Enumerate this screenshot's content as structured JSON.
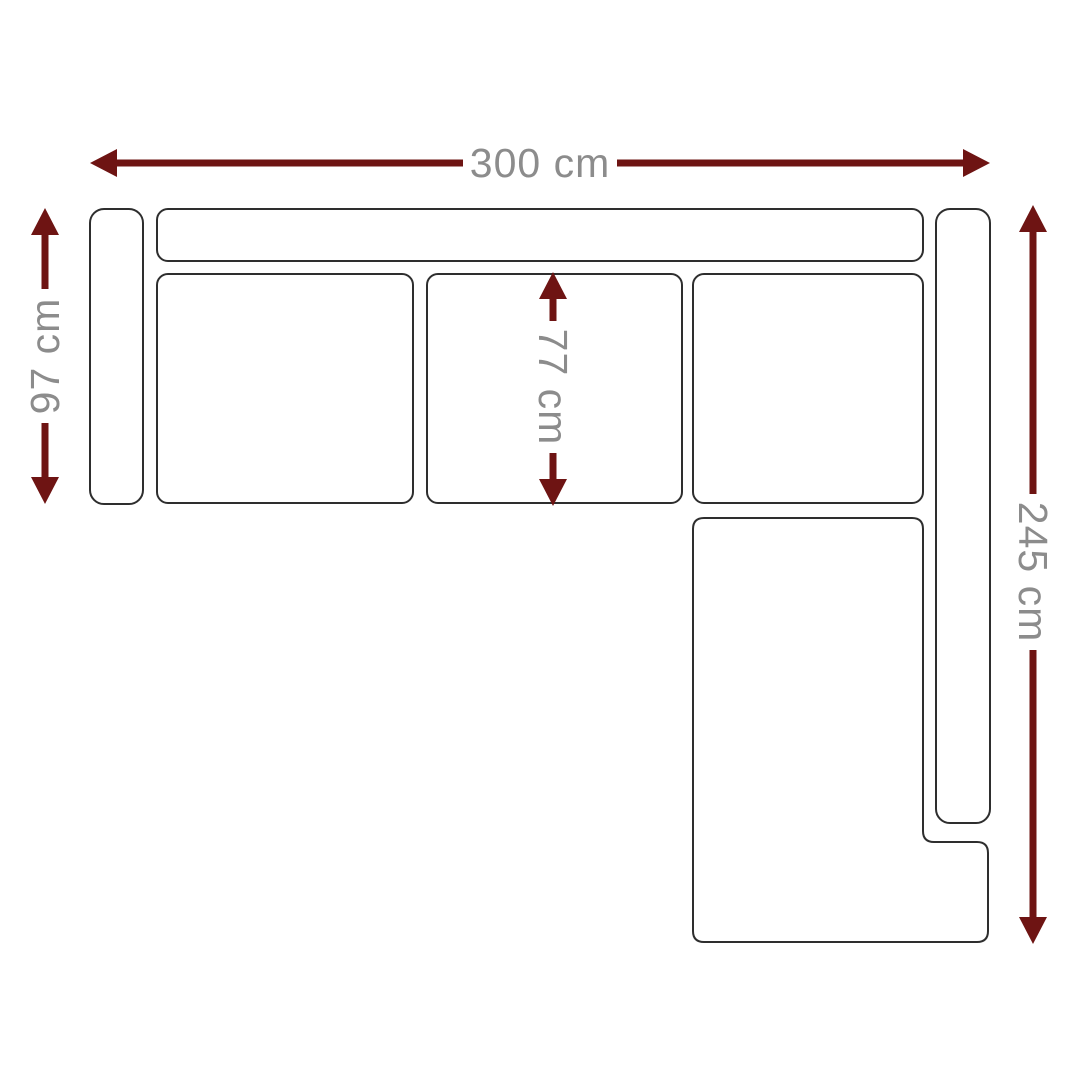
{
  "diagram": {
    "type": "corner-sofa-floorplan",
    "unit": "cm",
    "background_color": "#ffffff",
    "outline_color": "#2e2e2e",
    "arrow_color": "#6e1413",
    "label_color": "#8c8c8c",
    "dimensions": {
      "total_width": {
        "value": 300,
        "label": "300 cm"
      },
      "left_depth": {
        "value": 97,
        "label": "97 cm"
      },
      "seat_depth": {
        "value": 77,
        "label": "77 cm"
      },
      "right_length": {
        "value": 245,
        "label": "245 cm"
      }
    },
    "sections": [
      "left-armrest",
      "top-backrest",
      "seat-cushion-1",
      "seat-cushion-2",
      "seat-cushion-3",
      "right-backrest",
      "chaise-section"
    ]
  }
}
